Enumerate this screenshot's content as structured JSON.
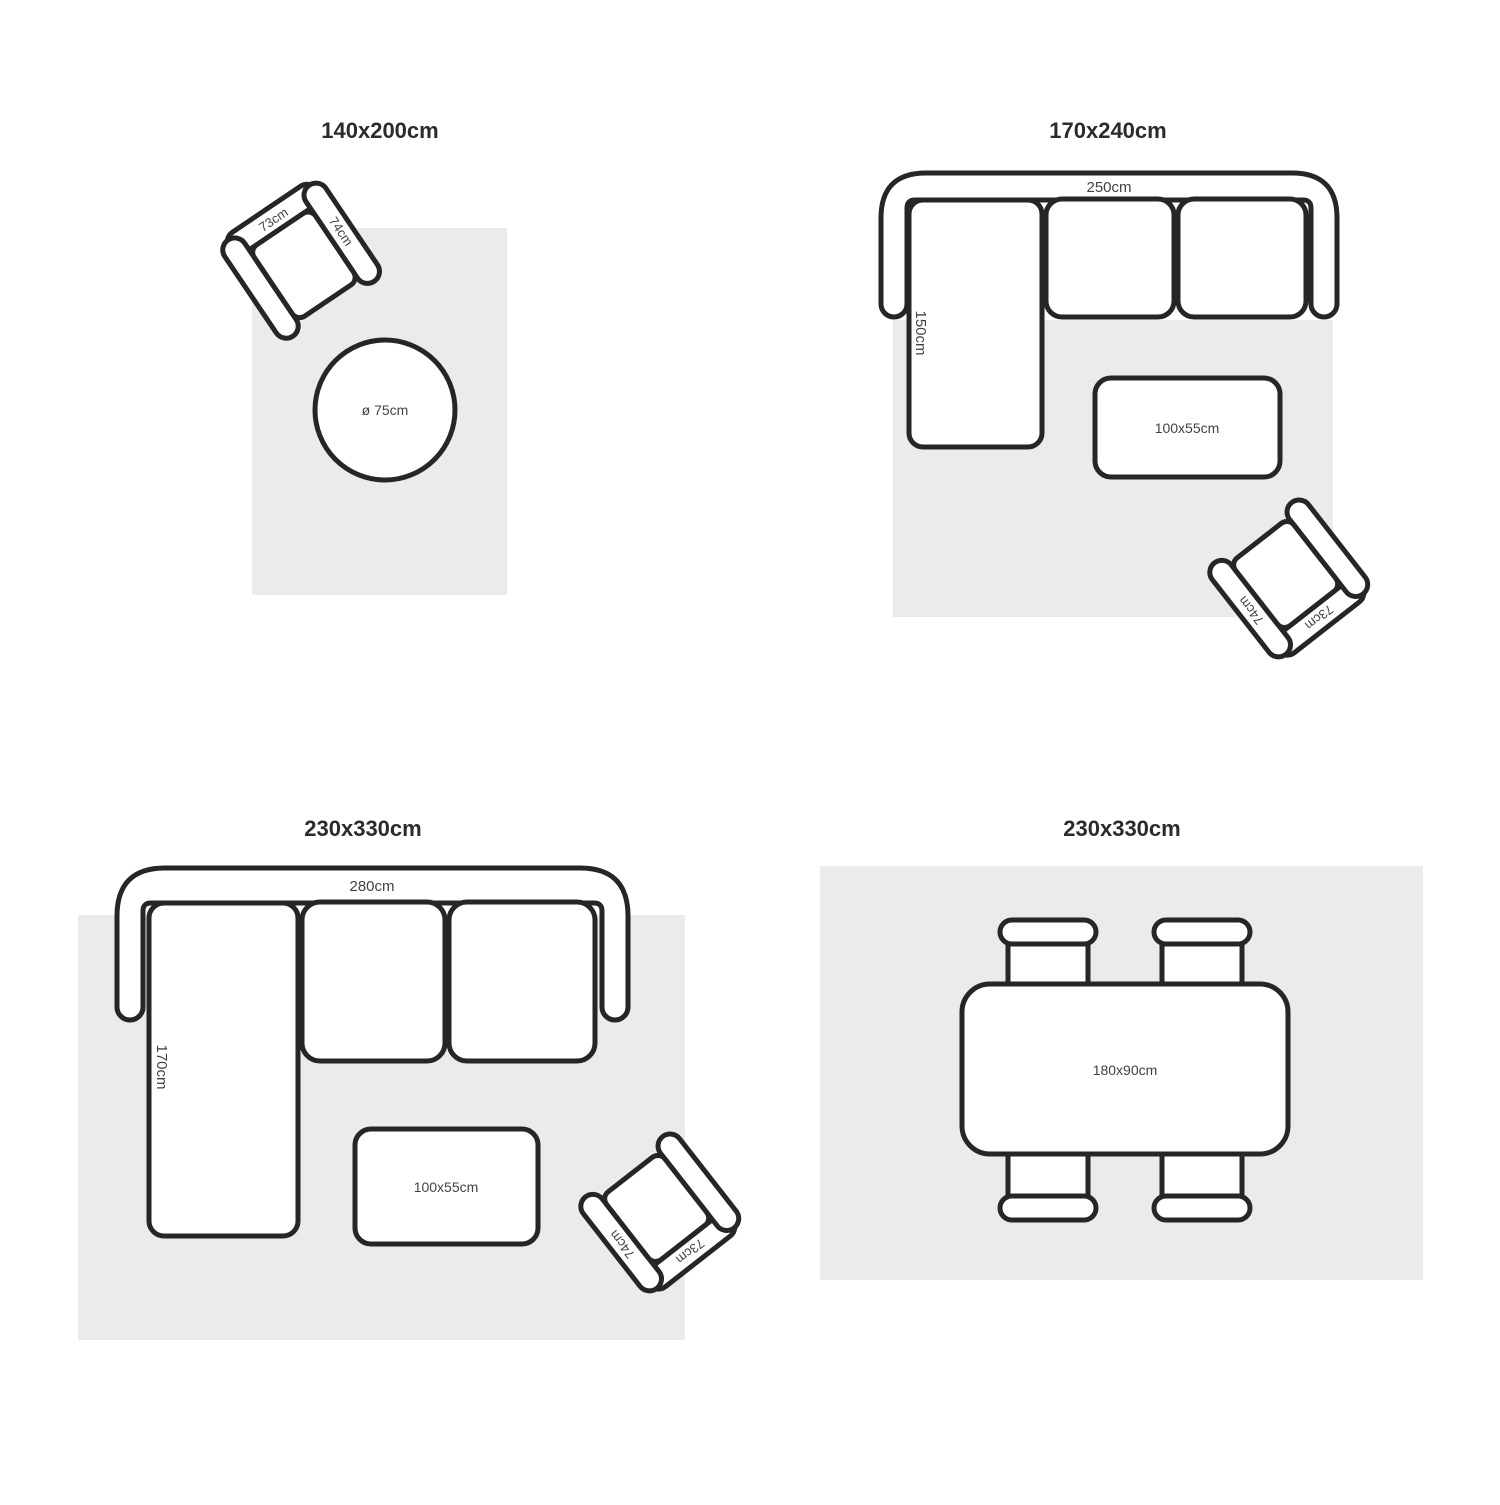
{
  "colors": {
    "outline": "#262626",
    "rug": "#ebebeb",
    "label": "#424242",
    "title": "#2b2b2b",
    "background": "#ffffff"
  },
  "quadrants": [
    {
      "title": "140x200cm",
      "armchair": {
        "back": "73cm",
        "arm": "74cm"
      },
      "round_table": {
        "label": "ø 75cm"
      }
    },
    {
      "title": "170x240cm",
      "sofa": {
        "width": "250cm",
        "depth": "150cm"
      },
      "coffee_table": {
        "label": "100x55cm"
      },
      "armchair": {
        "back": "73cm",
        "arm": "74cm"
      }
    },
    {
      "title": "230x330cm",
      "sofa": {
        "width": "280cm",
        "depth": "170cm"
      },
      "coffee_table": {
        "label": "100x55cm"
      },
      "armchair": {
        "back": "73cm",
        "arm": "74cm"
      }
    },
    {
      "title": "230x330cm",
      "dining_table": {
        "label": "180x90cm"
      }
    }
  ]
}
